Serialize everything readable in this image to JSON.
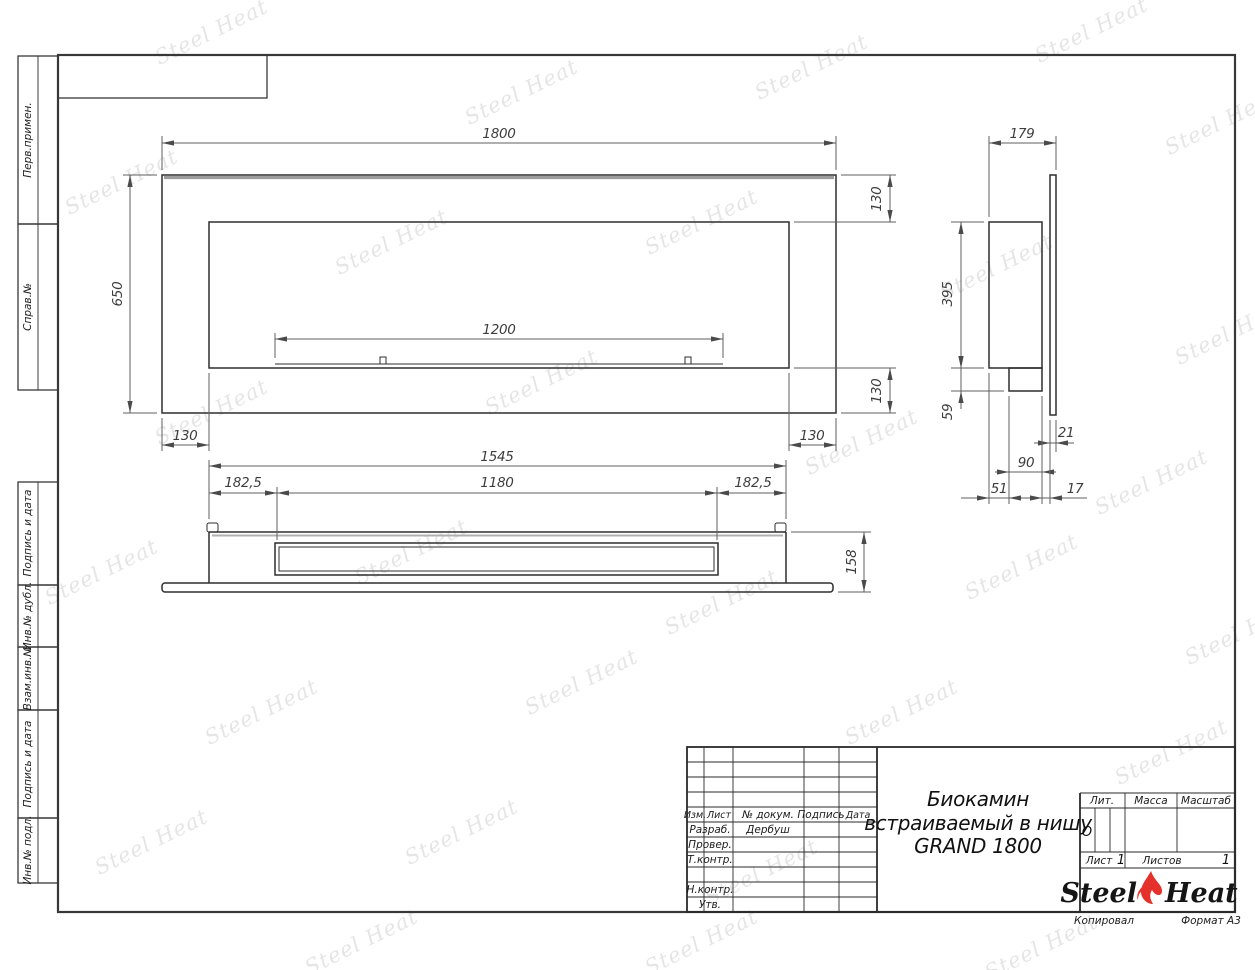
{
  "sheet": {
    "copied_label": "Копировал",
    "format_label": "Формат А3",
    "margin_labels": [
      "Перв.примен.",
      "Справ.№",
      "Подпись и дата",
      "Инв.№ дубл.",
      "Взам.инв.№",
      "Подпись и дата",
      "Инв.№ подл."
    ]
  },
  "title_block": {
    "product_name_lines": [
      "Биокамин",
      "встраиваемый в нишу",
      "GRAND 1800"
    ],
    "columns": {
      "izm": "Изм.",
      "list": "Лист",
      "doc": "№ докум.",
      "podpis": "Подпись",
      "data": "Дата"
    },
    "roles": {
      "razrab": "Разраб.",
      "prover": "Провер.",
      "tkontr": "Т.контр.",
      "nkontr": "Н.контр.",
      "utv": "Утв."
    },
    "razrab_name": "Дербуш",
    "lit": {
      "label": "Лит.",
      "value": "О"
    },
    "massa_label": "Масса",
    "masshtab_label": "Масштаб",
    "list_info": {
      "list_label": "Лист",
      "list_value": "1",
      "listov_label": "Листов",
      "listov_value": "1"
    },
    "logo": {
      "word1": "Steel",
      "word2": "Heat"
    }
  },
  "watermark": {
    "text": "Steel Heat"
  },
  "dimensions": {
    "front_view": {
      "width": "1800",
      "height": "650",
      "opening_width": "1200",
      "offset_top": "130",
      "offset_bottom": "130",
      "offset_left": "130",
      "offset_right": "130"
    },
    "top_view": {
      "length": "1545",
      "margin_left": "182,5",
      "burner_length": "1180",
      "margin_right": "182,5",
      "height": "158"
    },
    "side_view": {
      "depth": "179",
      "body_height": "395",
      "tray_height": "59",
      "panel_thickness": "21",
      "burner_depth": "90",
      "front_offset": "51",
      "gap": "17"
    }
  },
  "colors": {
    "outline": "#2e2e2e",
    "dim_line": "#5f5f5f",
    "accent_gray": "#9c9c9c",
    "flame_red": "#e5312b",
    "watermark": "#d6d6d6"
  }
}
